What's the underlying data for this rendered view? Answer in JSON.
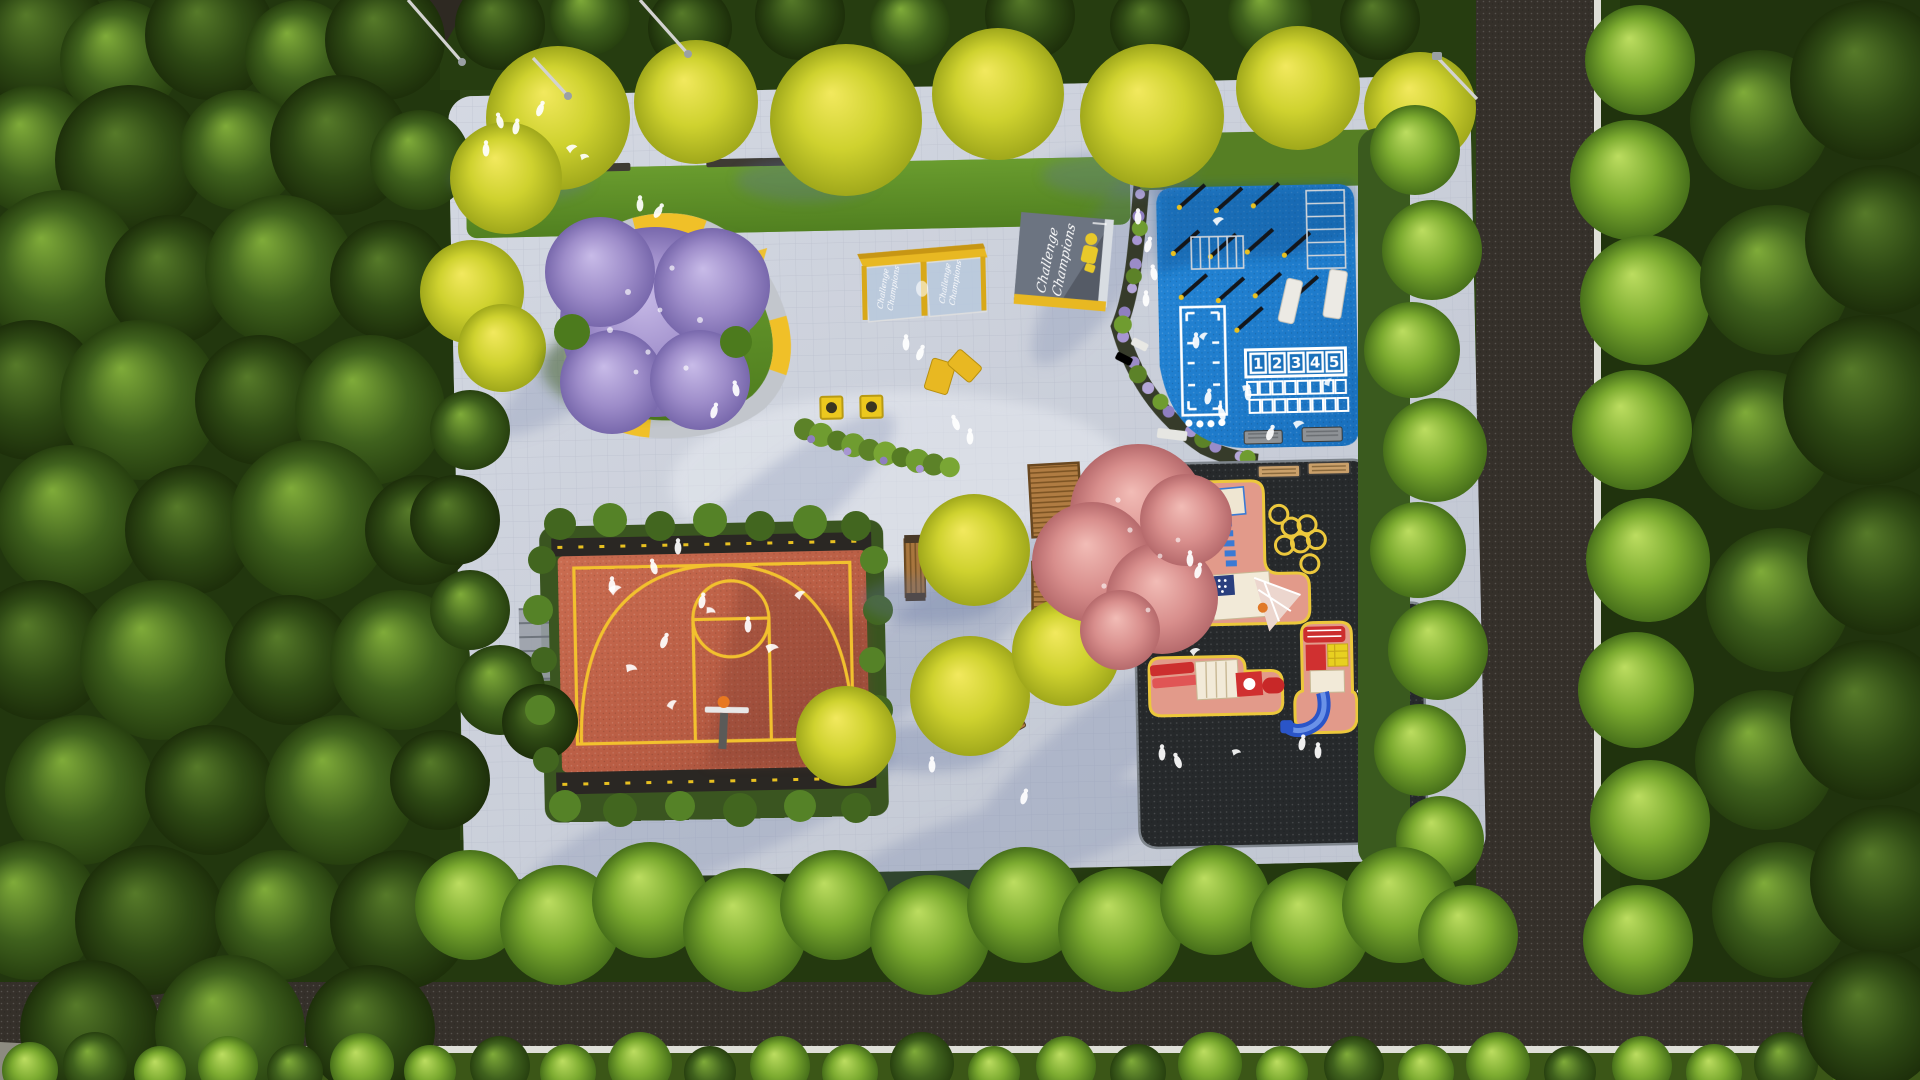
{
  "signboard": {
    "line1": "Challenge",
    "line2": "Champions"
  },
  "shelter": {
    "line1": "Challenge",
    "line2": "Champions"
  },
  "hopscotch": {
    "numbers": [
      "1",
      "2",
      "3",
      "4",
      "5"
    ]
  },
  "colors": {
    "plaza_paving": "#ccd1db",
    "road_asphalt": "#35302a",
    "road_line_white": "#dfdfd8",
    "fitness_court_blue": "#1e7ecf",
    "basketball_court_red": "#bb5e45",
    "court_line_yellow": "#f2c12e",
    "playground_surface_black": "#26292b",
    "playground_island_pink": "#e29a8a",
    "island_outline_yellow": "#ecc83c",
    "lawn_green": "#5d8f28",
    "canopy_yellow": "#e8b822",
    "ginkgo_yellow": "#d4cf35",
    "jacaranda_purple": "#9d8cc9",
    "blossom_pink": "#d88e8c",
    "tree_bright_green": "#8fc23c",
    "forest_dark_green": "#2c4414",
    "wood_brown": "#a8763e"
  }
}
